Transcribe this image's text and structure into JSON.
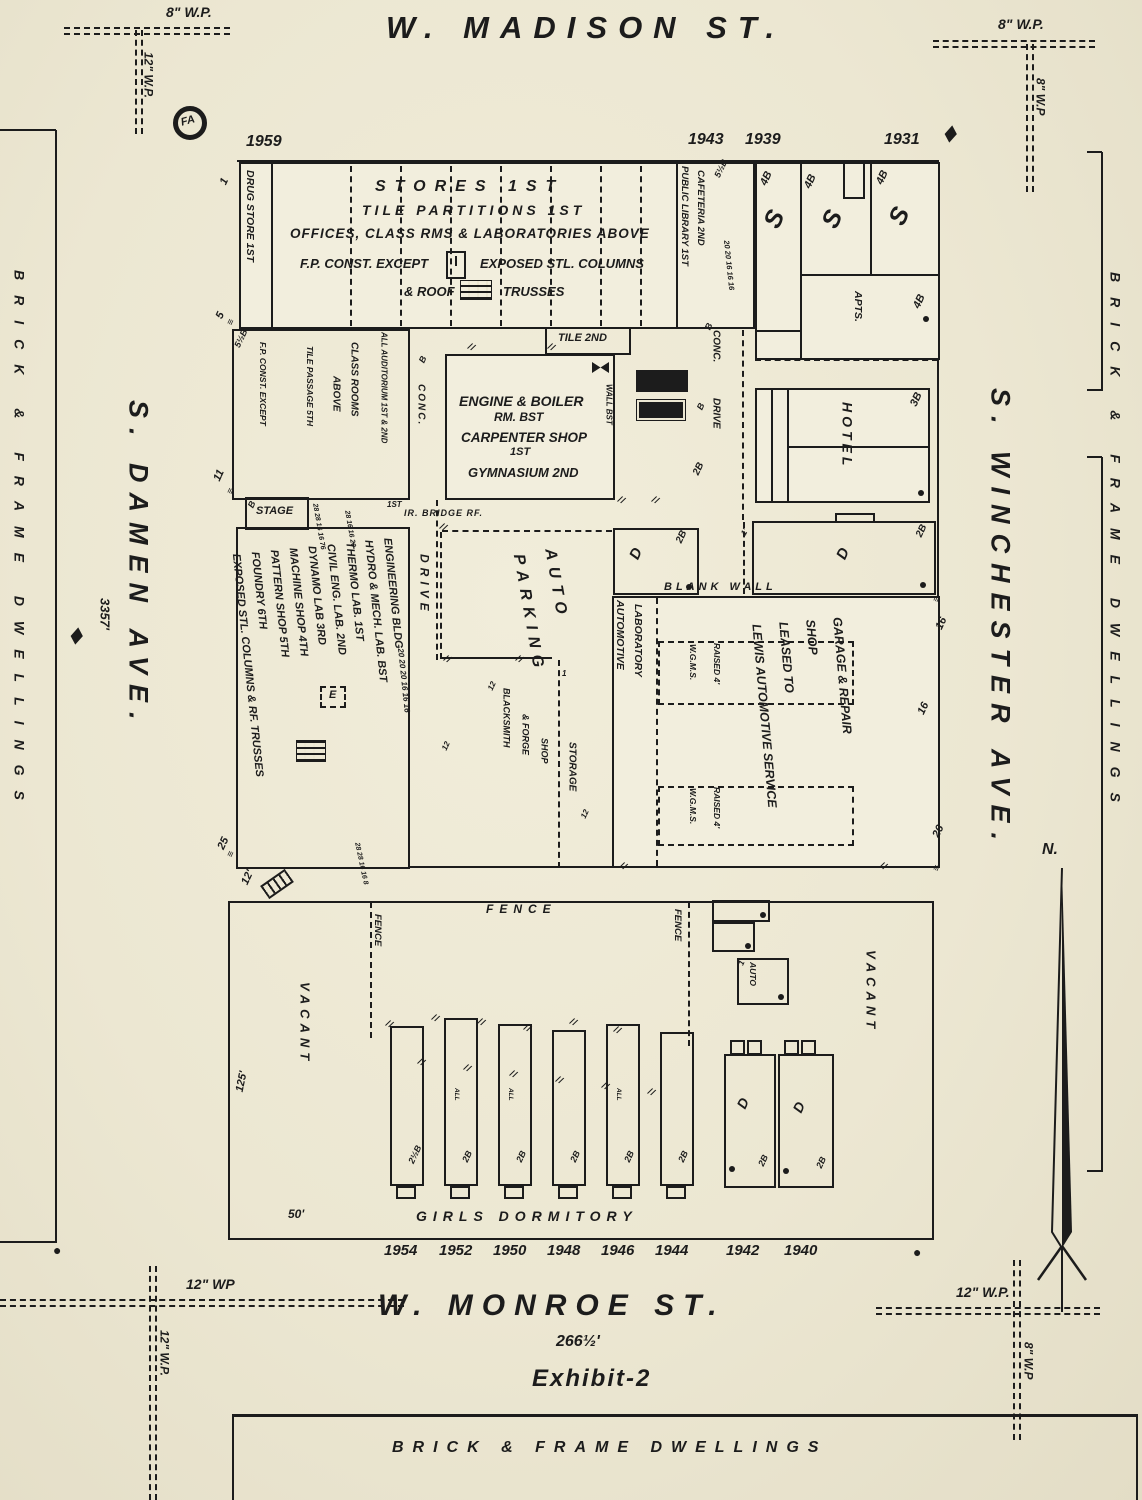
{
  "paper_color": "#ece7d2",
  "ink_color": "#1c1c1c",
  "exhibit": "Exhibit-2",
  "compass": "N.",
  "fire_alarm": "FA",
  "streets": {
    "madison": "W. MADISON ST.",
    "monroe": "W. MONROE ST.",
    "monroe_width": "266½'",
    "damen": "S. DAMEN AVE.",
    "damen_dim": "3357'",
    "winchester": "S. WINCHESTER AVE."
  },
  "surroundings": {
    "west": "BRICK & FRAME DWELLINGS",
    "east": "BRICK & FRAME DWELLINGS",
    "south": "BRICK & FRAME DWELLINGS"
  },
  "water_pipes": {
    "top_left_h": "8\" W.P.",
    "top_left_v": "12\" W.P.",
    "top_right_h": "8\" W.P.",
    "top_right_v": "8\" W.P",
    "bottom_left_h": "12\" WP",
    "bottom_left_v": "12\" W.P.",
    "bottom_right_h": "12\" W.P.",
    "bottom_right_v": "8\" W.P"
  },
  "addresses_top": [
    "1959",
    "1943",
    "1939",
    "1931"
  ],
  "addresses_bottom": [
    "1954",
    "1952",
    "1950",
    "1948",
    "1946",
    "1944",
    "1942",
    "1940"
  ],
  "frontage": {
    "m1": "1",
    "m5": "5",
    "m11": "11",
    "m25": "25",
    "d12": "12'",
    "d50": "50'",
    "d125": "125'",
    "e16a": "16",
    "e16b": "16",
    "e26": "26"
  },
  "main_building": {
    "line1": "STORES 1ST",
    "line2": "TILE PARTITIONS 1ST",
    "line3": "OFFICES, CLASS RMS & LABORATORIES ABOVE",
    "line4a": "F.P. CONST. EXCEPT",
    "line4b": "EXPOSED STL. COLUMNS",
    "line5a": "& ROOF",
    "line5b": "TRUSSES",
    "drug_store": "DRUG STORE 1ST",
    "library": "PUBLIC LIBRARY 1ST",
    "cafeteria": "CAFETERIA 2ND",
    "height_lib": "5½B",
    "floors_col": "20 20 16 16 16"
  },
  "stores_ne": {
    "s1": "S",
    "s2": "S",
    "s3": "S",
    "h1": "4B",
    "h2": "4B",
    "h3": "4B",
    "h4": "4B",
    "apts": "APTS."
  },
  "hotel": {
    "name": "HOTEL",
    "height": "3B"
  },
  "drives": {
    "conc1": "CONC.",
    "drive1": "DRIVE",
    "conc2": "CONC.",
    "drive2": "DRIVE",
    "b1": "B",
    "b2": "B",
    "b3": "B",
    "b4": "2B"
  },
  "auditorium": {
    "l1": "ALL AUDITORIUM 1ST & 2ND",
    "l2": "CLASS ROOMS",
    "l3": "ABOVE",
    "l4": "TILE PASSAGE 5TH",
    "l5": "F.P. CONST. EXCEPT",
    "height": "5½B",
    "b": "B",
    "stage": "STAGE",
    "first": "1ST",
    "bridge": "IR. BRIDGE RF.",
    "nums1": "28 28 16 16 76",
    "nums2": "28 16 16 20"
  },
  "engine": {
    "l1": "ENGINE & BOILER",
    "l2": "RM. BST",
    "l3": "CARPENTER SHOP",
    "l4": "1ST",
    "l5": "GYMNASIUM 2ND",
    "tile": "TILE 2ND",
    "wall": "WALL BST"
  },
  "engineering": {
    "lines": [
      "ENGINEERING BLDG",
      "HYDRO & MECH. LAB. BST",
      "THERMO LAB. 1ST",
      "CIVIL ENG. LAB. 2ND",
      "DYNAMO LAB 3RD",
      "MACHINE SHOP 4TH",
      "PATTERN SHOP 5TH",
      "FOUNDRY 6TH",
      "EXPOSED STL. COLUMNS & RF. TRUSSES"
    ],
    "floors": "20 20 20 16 16 16",
    "nums": "28 28 16 16 8",
    "skylight": "E"
  },
  "yard": {
    "parking_lines": [
      "AUTO",
      "PARKING"
    ],
    "blacksmith1": "BLACKSMITH",
    "blacksmith2": "& FORGE",
    "blacksmith3": "SHOP",
    "storage": "STORAGE",
    "n12a": "12",
    "n12b": "12",
    "n12c": "12",
    "n1": "1"
  },
  "garage": {
    "lines": [
      "GARAGE & REPAIR",
      "SHOP",
      "LEASED TO",
      "LEWIS AUTOMOTIVE SERVICE"
    ],
    "lab1": "AUTOMOTIVE",
    "lab2": "LABORATORY",
    "blank_wall": "BLANK WALL",
    "wgms1": "W.G.M.S.",
    "raised1": "RAISED 4'",
    "wgms2": "W.G.M.S.",
    "raised2": "RAISED 4'",
    "d_small": "D",
    "d_small_h": "2B",
    "d_right": "D",
    "d_right_h": "2B",
    "one_ft": "1'"
  },
  "dormitory": {
    "title": "GIRLS DORMITORY",
    "fence_top": "FENCE",
    "fence_v1": "FENCE",
    "fence_v2": "FENCE",
    "vacant_left": "VACANT",
    "vacant_right": "VACANT",
    "auto_shed": "AUTO",
    "auto_no": "1",
    "all_note": "ALL",
    "houses": [
      {
        "h": "2½B"
      },
      {
        "h": "2B"
      },
      {
        "h": "2B"
      },
      {
        "h": "2B"
      },
      {
        "h": "2B"
      },
      {
        "h": "2B"
      }
    ],
    "d1": "D",
    "d1h": "2B",
    "d2": "D",
    "d2h": "2B"
  },
  "symbols": {
    "hatch": "//",
    "tick": "≡",
    "hydrant_diamond": "◆",
    "hydrant_dot": "●"
  }
}
